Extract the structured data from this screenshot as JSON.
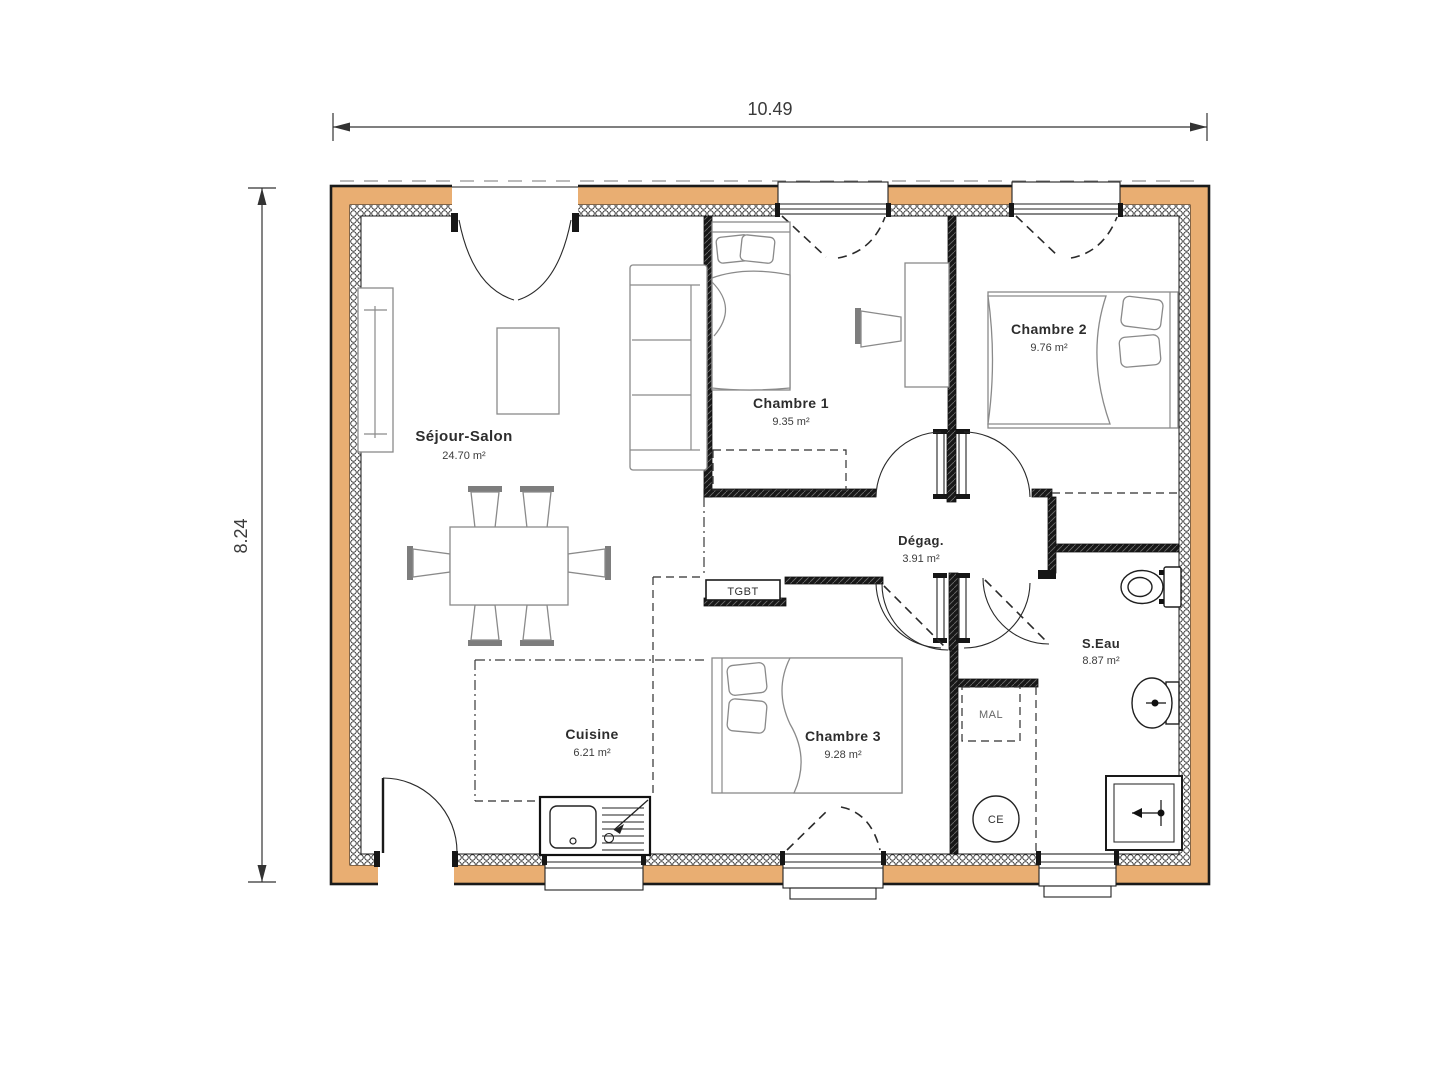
{
  "plan": {
    "dimension_width": "10.49",
    "dimension_height": "8.24",
    "rooms": [
      {
        "id": "sejour",
        "name": "Séjour-Salon",
        "area": "24.70 m²"
      },
      {
        "id": "chambre1",
        "name": "Chambre 1",
        "area": "9.35 m²"
      },
      {
        "id": "chambre2",
        "name": "Chambre 2",
        "area": "9.76 m²"
      },
      {
        "id": "chambre3",
        "name": "Chambre 3",
        "area": "9.28 m²"
      },
      {
        "id": "cuisine",
        "name": "Cuisine",
        "area": "6.21 m²"
      },
      {
        "id": "degagement",
        "name": "Dégag.",
        "area": "3.91 m²"
      },
      {
        "id": "salle_eau",
        "name": "S.Eau",
        "area": "8.87 m²"
      }
    ],
    "labels": {
      "electrical_panel": "TGBT",
      "washing_machine": "MAL",
      "water_heater": "CE"
    },
    "colors": {
      "exterior_wall_fill": "#e9ae72",
      "wall_line": "#1a1a1a",
      "furniture_line": "#8a8a8a",
      "text": "#333333",
      "background": "#ffffff"
    }
  }
}
